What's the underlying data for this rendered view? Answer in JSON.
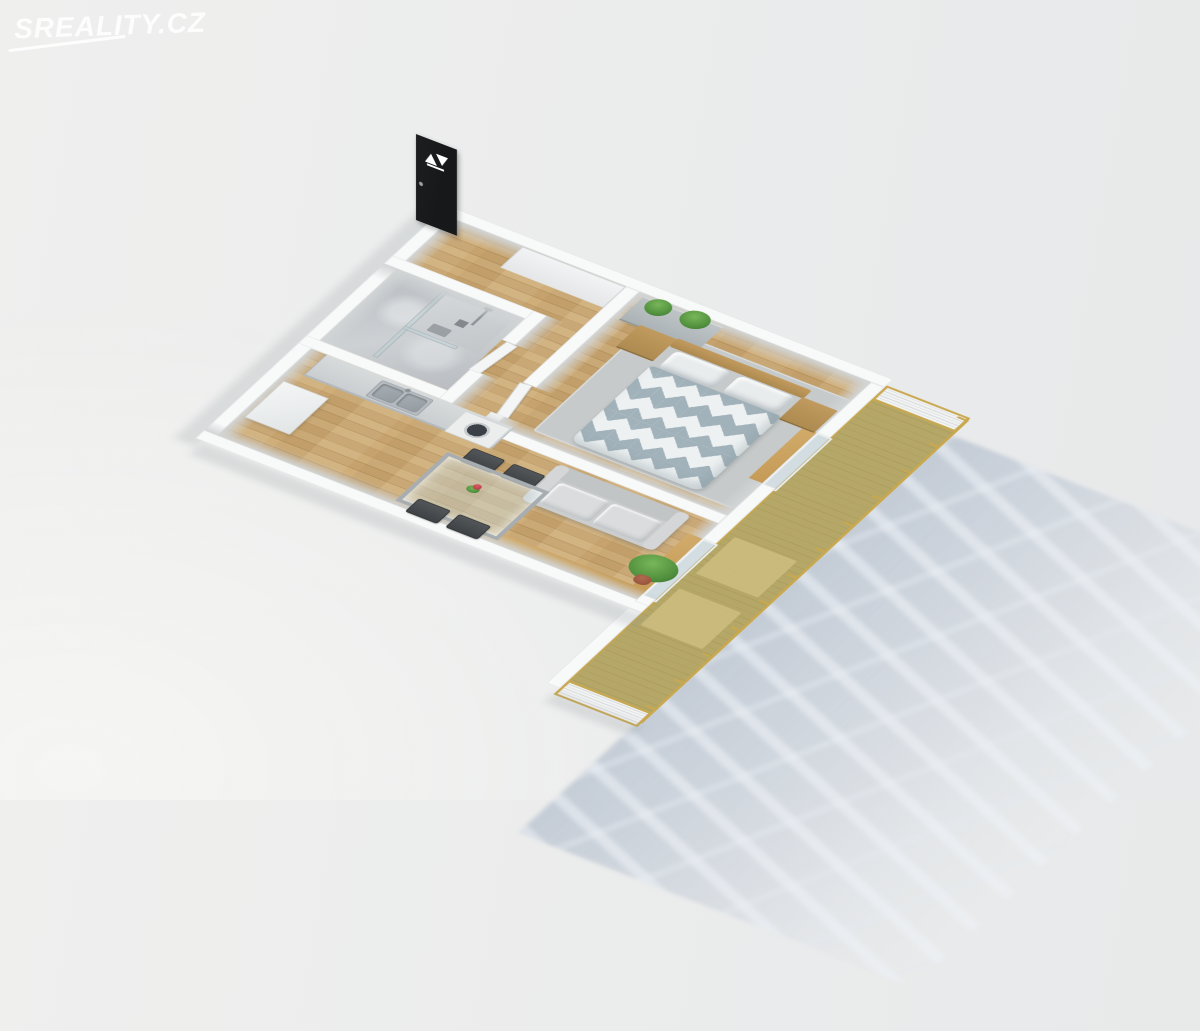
{
  "watermark": {
    "text": "SREALITY.CZ"
  },
  "scene": {
    "type": "3d-floor-plan-dollhouse-render",
    "view": "isometric-from-above",
    "entrance_door_logo": "white-twin-triangle-emblem",
    "rooms": [
      {
        "name": "entry-hall",
        "floor": "wood",
        "features": [
          "black-entrance-door",
          "built-in-wardrobe"
        ]
      },
      {
        "name": "bathroom",
        "floor": "gray-marble",
        "features": [
          "walk-in-shower",
          "glass-partition",
          "shower-fixtures",
          "floor-drain",
          "white-door"
        ]
      },
      {
        "name": "kitchen-living-room",
        "floor": "wood",
        "features": [
          "kitchen-counter",
          "double-steel-sink",
          "washing-machine",
          "refrigerator",
          "gray-sofa",
          "glass-dining-table",
          "four-dark-chairs",
          "flower-vase",
          "potted-plant",
          "wood-window-sill"
        ]
      },
      {
        "name": "bedroom",
        "floor": "wood-with-gray-rug",
        "features": [
          "double-bed-diamond-duvet",
          "wood-headboard",
          "nightstand-left",
          "nightstand-right",
          "gray-dresser",
          "green-plants",
          "balcony-door"
        ]
      },
      {
        "name": "balcony",
        "floor": "olive-wood-decking",
        "features": [
          "gold-frame-railing",
          "white-slat-panel-north",
          "white-slat-panel-south",
          "deck-mats"
        ]
      }
    ],
    "ground_shadow": "railing-and-window-frame-shadow-bottom-right"
  },
  "colors": {
    "watermark": "rgba(255,255,255,0.88)",
    "wall": "#f8f9f9",
    "wall-face": "#d2d5d6",
    "wall-edge": "#e6e8e9",
    "wood": "#c6a36e",
    "wood-seam": "#b7945e",
    "wood-light": "#cfae7a",
    "marble": "#b9bdc1",
    "marble-light": "#cdd1d4",
    "rug": "#c7caca",
    "duvet-gray": "#a2b2ba",
    "duvet-white": "#edf1f2",
    "pillow": "#e9eced",
    "furn-wood": "#ad8a50",
    "sofa": "#cbcdce",
    "sofa-seat": "#dadcdd",
    "counter": "#c9cdcf",
    "steel": "#b4babf",
    "steel-dark": "#939ba1",
    "washer": "#eceeee",
    "washer-door": "#3b4046",
    "chair": "#3e4144",
    "balcony": "#b1a25f",
    "mat": "#cfc083",
    "gold": "#c9a84f",
    "slat": "#f1f2f2",
    "plant": "#4f8f3c",
    "plant-light": "#79b65a",
    "plant-dark": "#35682a",
    "pot": "#8f4c39",
    "door-black": "#17181a",
    "door-white": "#f4f5f5"
  }
}
